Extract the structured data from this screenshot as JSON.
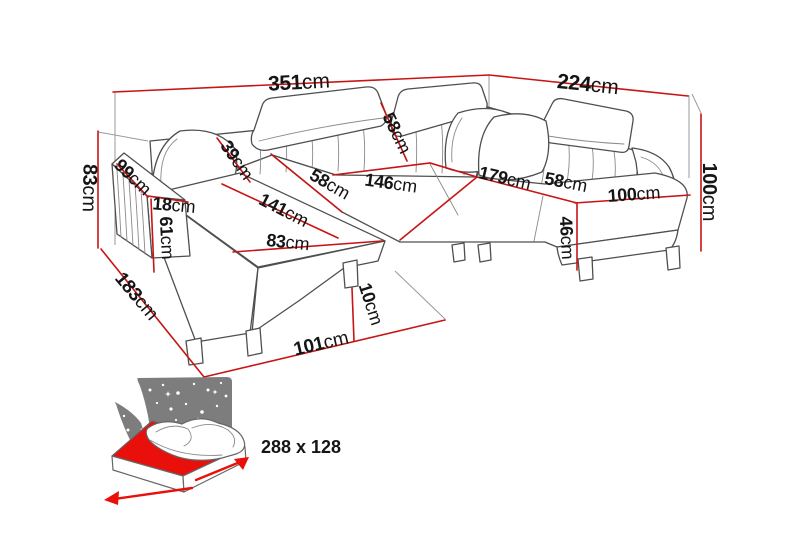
{
  "title": "U-shaped corner sofa dimension diagram",
  "colors": {
    "dimension_red": "#c81414",
    "sofa_outline": "#4f4f4f",
    "extension_gray": "#9a9a9a",
    "label_text": "#151515",
    "icon_gray": "#7d7d7d",
    "mattress_red": "#e9100c"
  },
  "dimensions": [
    {
      "id": "overall-width",
      "num": "351",
      "unit": "cm",
      "x": 299,
      "y": 82,
      "rot": -3,
      "size": 21
    },
    {
      "id": "overall-depth-right",
      "num": "224",
      "unit": "cm",
      "x": 588,
      "y": 84,
      "rot": 6,
      "size": 21
    },
    {
      "id": "height-left",
      "num": "83",
      "unit": "cm",
      "x": 90,
      "y": 188,
      "rot": 91,
      "size": 20
    },
    {
      "id": "armrest-depth",
      "num": "99",
      "unit": "cm",
      "x": 133,
      "y": 177,
      "rot": 44,
      "size": 18
    },
    {
      "id": "armrest-width",
      "num": "18",
      "unit": "cm",
      "x": 174,
      "y": 205,
      "rot": 5,
      "size": 18
    },
    {
      "id": "armrest-height",
      "num": "61",
      "unit": "cm",
      "x": 167,
      "y": 238,
      "rot": 87,
      "size": 18
    },
    {
      "id": "backrest-depth",
      "num": "39",
      "unit": "cm",
      "x": 237,
      "y": 160,
      "rot": 55,
      "size": 18
    },
    {
      "id": "headrest-width",
      "num": "58",
      "unit": "cm",
      "x": 397,
      "y": 133,
      "rot": 64,
      "size": 18
    },
    {
      "id": "seat-depth-left",
      "num": "58",
      "unit": "cm",
      "x": 330,
      "y": 184,
      "rot": 30,
      "size": 18
    },
    {
      "id": "seat-width-middle",
      "num": "146",
      "unit": "cm",
      "x": 391,
      "y": 183,
      "rot": 8,
      "size": 18
    },
    {
      "id": "chaise-length",
      "num": "141",
      "unit": "cm",
      "x": 284,
      "y": 210,
      "rot": 27,
      "size": 18
    },
    {
      "id": "chaise-width",
      "num": "83",
      "unit": "cm",
      "x": 288,
      "y": 242,
      "rot": 6,
      "size": 18
    },
    {
      "id": "seat-width-right",
      "num": "179",
      "unit": "cm",
      "x": 505,
      "y": 178,
      "rot": 13,
      "size": 18
    },
    {
      "id": "seat-depth-right",
      "num": "58",
      "unit": "cm",
      "x": 566,
      "y": 182,
      "rot": 11,
      "size": 18
    },
    {
      "id": "chaise-width-right",
      "num": "100",
      "unit": "cm",
      "x": 634,
      "y": 194,
      "rot": -4,
      "size": 18
    },
    {
      "id": "seat-height",
      "num": "46",
      "unit": "cm",
      "x": 567,
      "y": 238,
      "rot": 87,
      "size": 18
    },
    {
      "id": "height-right",
      "num": "100",
      "unit": "cm",
      "x": 710,
      "y": 192,
      "rot": 90,
      "size": 20
    },
    {
      "id": "side-depth-left",
      "num": "183",
      "unit": "cm",
      "x": 137,
      "y": 296,
      "rot": 50,
      "size": 19
    },
    {
      "id": "front-width",
      "num": "101",
      "unit": "cm",
      "x": 321,
      "y": 343,
      "rot": -13,
      "size": 19
    },
    {
      "id": "leg-height",
      "num": "10",
      "unit": "cm",
      "x": 371,
      "y": 304,
      "rot": 72,
      "size": 18
    }
  ],
  "sleeping_area": {
    "label": "288 x 128"
  }
}
